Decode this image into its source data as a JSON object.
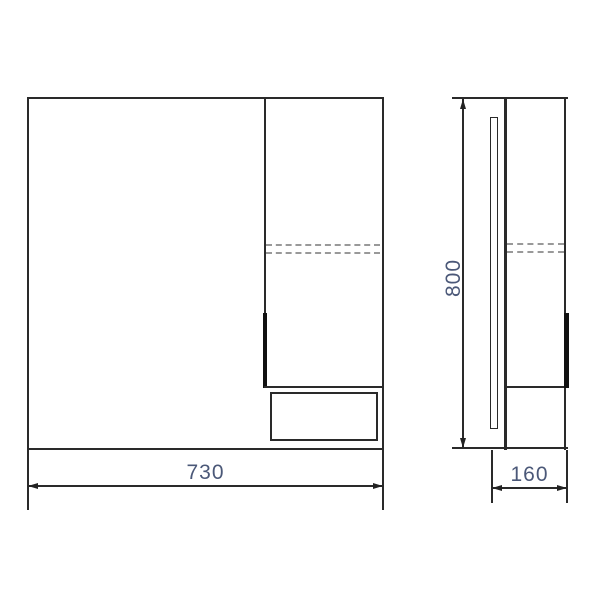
{
  "drawing": {
    "dimensions": {
      "width": {
        "value": "730"
      },
      "height": {
        "value": "800"
      },
      "depth": {
        "value": "160"
      }
    },
    "colors": {
      "line": "#2a2a2a",
      "dashed_line": "#999999",
      "dimension_text": "#4b5878",
      "background": "#ffffff"
    }
  }
}
